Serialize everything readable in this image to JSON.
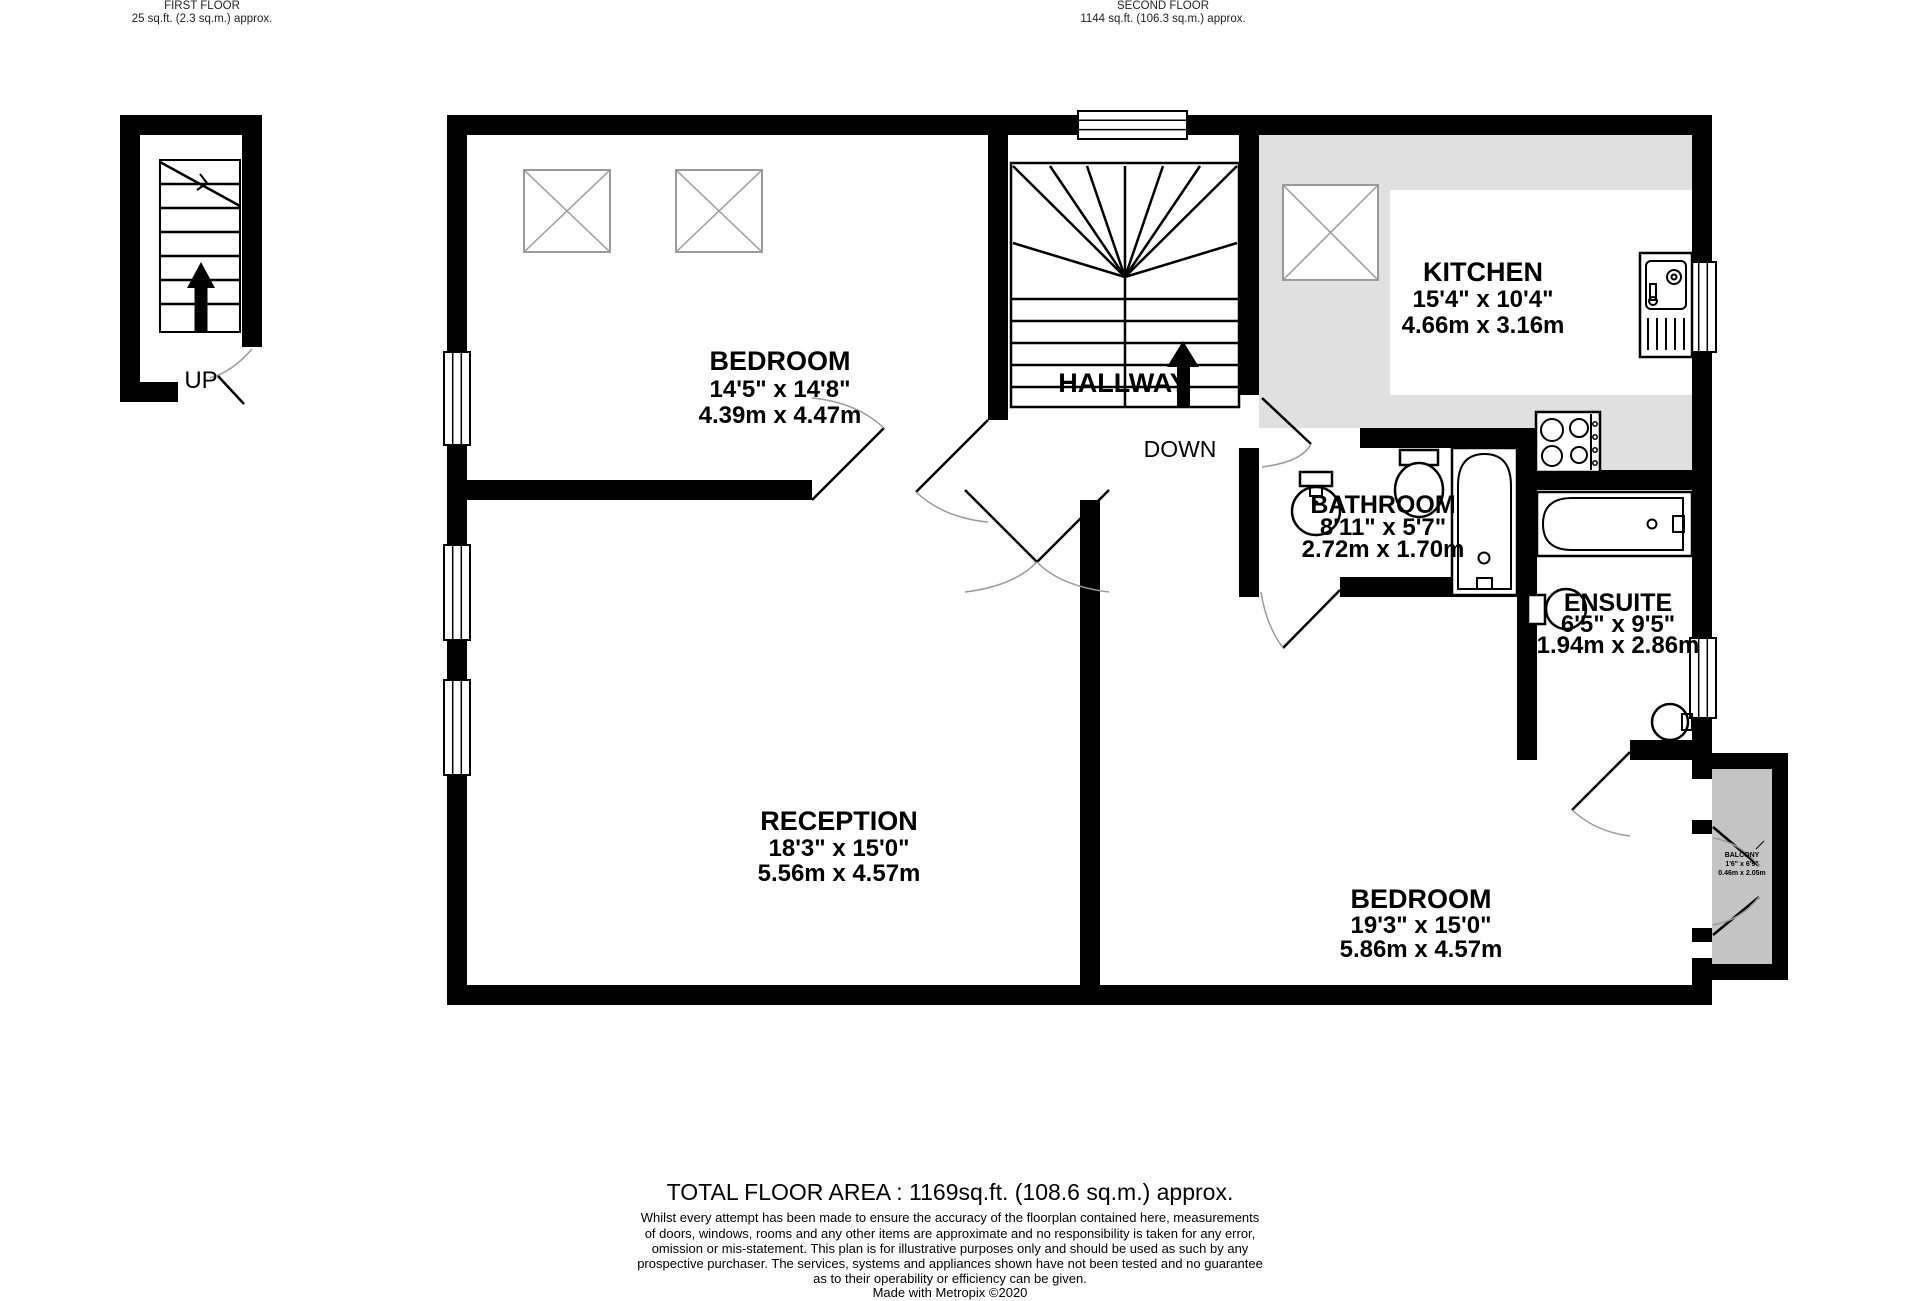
{
  "header": {
    "first_floor": {
      "title": "FIRST FLOOR",
      "area": "25 sq.ft. (2.3 sq.m.) approx."
    },
    "second_floor": {
      "title": "SECOND FLOOR",
      "area": "1144 sq.ft. (106.3 sq.m.) approx."
    }
  },
  "rooms": {
    "bedroom1": {
      "name": "BEDROOM",
      "imperial": "14'5\" x 14'8\"",
      "metric": "4.39m x 4.47m"
    },
    "kitchen": {
      "name": "KITCHEN",
      "imperial": "15'4\" x 10'4\"",
      "metric": "4.66m x 3.16m"
    },
    "hallway": {
      "name": "HALLWAY"
    },
    "bathroom": {
      "name": "BATHROOM",
      "imperial": "8'11\" x 5'7\"",
      "metric": "2.72m x 1.70m"
    },
    "ensuite": {
      "name": "ENSUITE",
      "imperial": "6'5\" x 9'5\"",
      "metric": "1.94m x 2.86m"
    },
    "reception": {
      "name": "RECEPTION",
      "imperial": "18'3\" x 15'0\"",
      "metric": "5.56m x 4.57m"
    },
    "bedroom2": {
      "name": "BEDROOM",
      "imperial": "19'3\" x 15'0\"",
      "metric": "5.86m x 4.57m"
    },
    "balcony": {
      "name": "BALCONY",
      "imperial": "1'6\" x 6'9\"",
      "metric": "0.46m x 2.05m"
    }
  },
  "stairs": {
    "up_label": "UP",
    "down_label": "DOWN"
  },
  "footer": {
    "total": "TOTAL FLOOR AREA : 1169sq.ft. (108.6 sq.m.) approx.",
    "disclaimer": [
      "Whilst every attempt has been made to ensure the accuracy of the floorplan contained here, measurements",
      "of doors, windows, rooms and any other items are approximate and no responsibility is taken for any error,",
      "omission or mis-statement. This plan is for illustrative purposes only and should be used as such by any",
      "prospective purchaser. The services, systems and appliances shown have not been tested and no guarantee",
      "as to their operability or efficiency can be given."
    ],
    "credit": "Made with Metropix ©2020"
  },
  "colors": {
    "wall": "#000000",
    "kitchen_floor": "#e0e0e0",
    "balcony_floor": "#c4c4c4",
    "outline_gray": "#9a9a9a"
  }
}
